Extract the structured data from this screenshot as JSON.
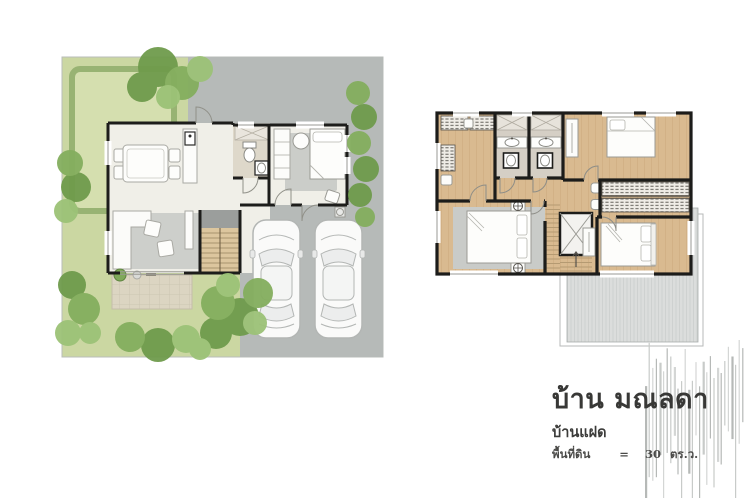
{
  "title_block": {
    "title": "บ้าน มณลดา",
    "subtitle": "บ้านแฝด",
    "area": {
      "label": "พื้นที่ดิน",
      "equals": "=",
      "value": "30",
      "unit": "ตร.ว."
    }
  },
  "plans": {
    "ground_floor": {
      "name": "ground-floor-site-plan",
      "features": [
        "lawn-garden",
        "hedge",
        "trees",
        "driveway",
        "carport-with-two-cars",
        "living-room-sofa",
        "dining-table-4-chairs",
        "kitchen-counter",
        "bathroom",
        "bedroom",
        "staircase",
        "terrace",
        "entrance-door"
      ]
    },
    "second_floor": {
      "name": "second-floor-plan",
      "features": [
        "bedroom-top-left",
        "bedroom-top-right",
        "master-bedroom",
        "bedroom-bottom-right",
        "bathroom-1",
        "bathroom-2",
        "wardrobes",
        "staircase",
        "roof-terrace"
      ]
    }
  },
  "colors": {
    "background": "#ffffff",
    "lawn": "#cbd7a2",
    "hedge": "#96b271",
    "tree_dark": "#6f9b4c",
    "tree_light": "#9cc277",
    "driveway": "#b6bab8",
    "interior_floor": "#f0efe8",
    "wood_floor": "#d9ba90",
    "wall": "#1d1d1b",
    "rug": "#c9cbc8",
    "terrace": "#dcd5c2",
    "bath_floor": "#d5cfc5",
    "roof": "#dbdddc",
    "stripe_gray": "#c3c6c4",
    "text": "#3b3b39"
  }
}
